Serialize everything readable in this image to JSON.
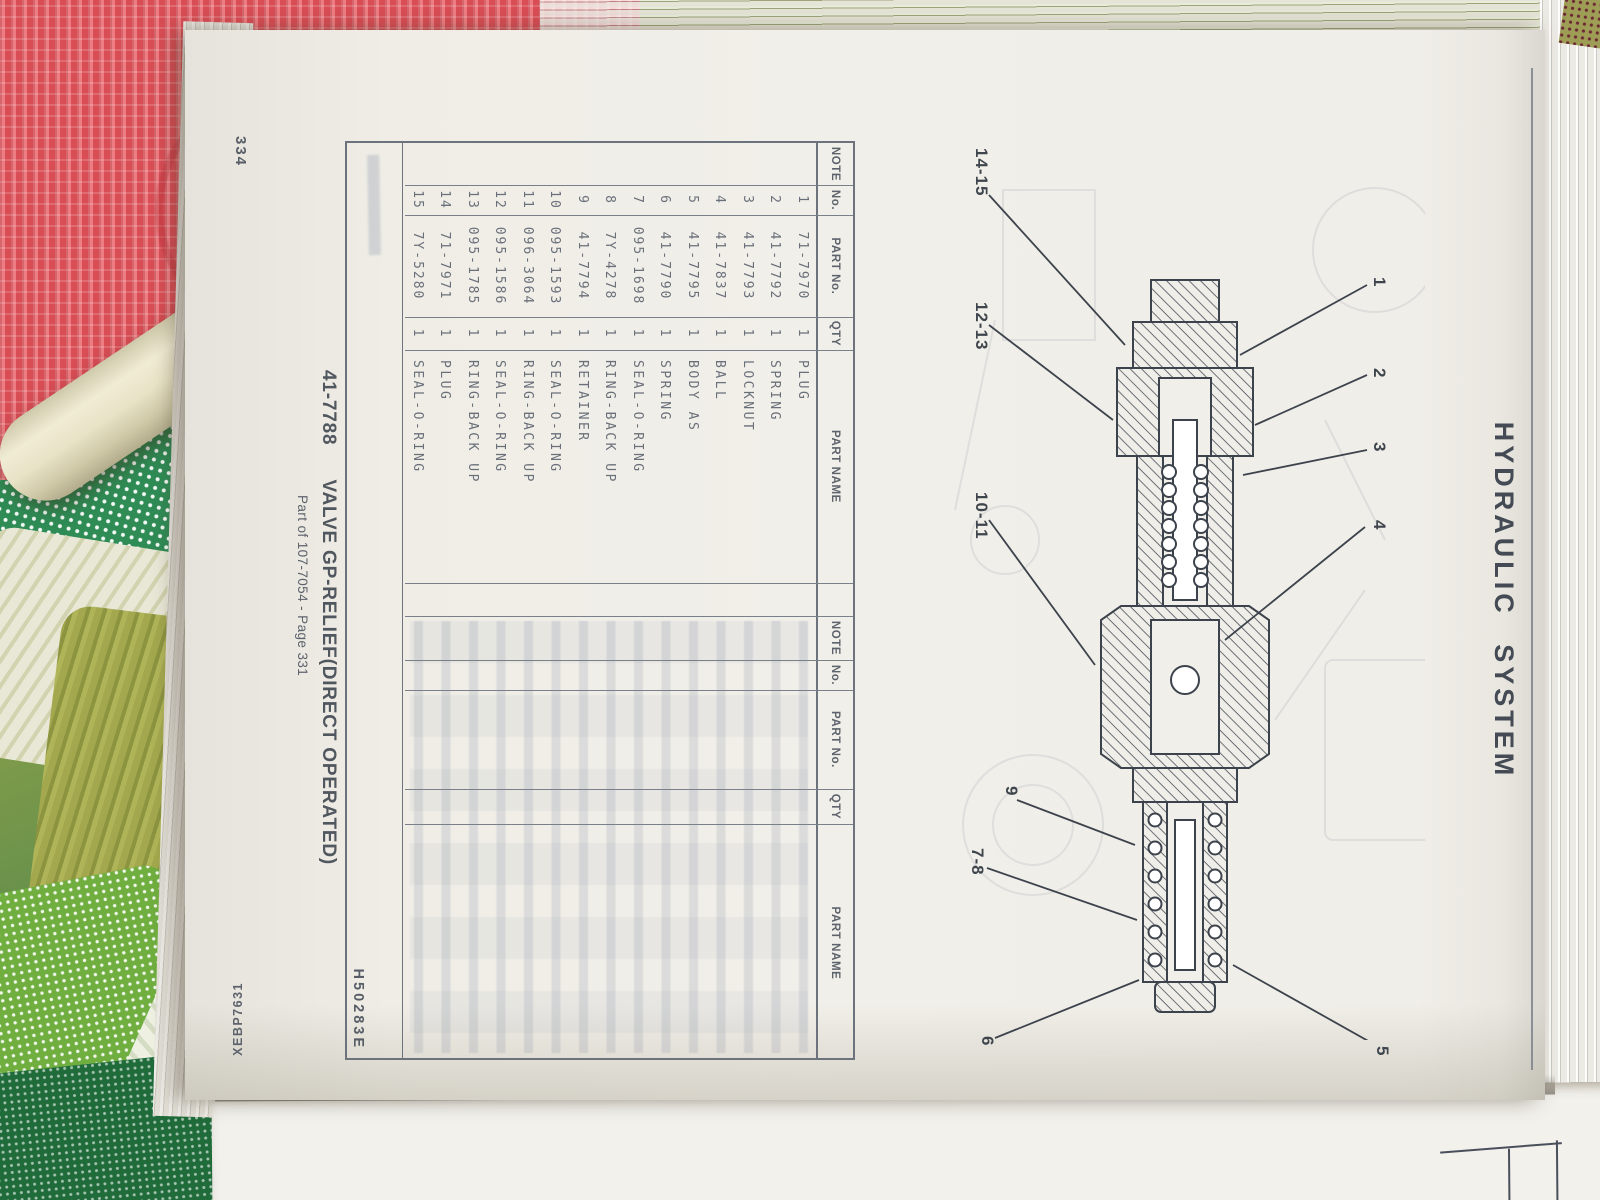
{
  "page": {
    "section_title": "HYDRAULIC SYSTEM",
    "page_number": "334",
    "form_code": "XEBP7631",
    "figure_code": "H50283E",
    "caption_part_no": "41-7788",
    "caption_title": "VALVE GP-RELIEF(DIRECT OPERATED)",
    "caption_subtitle": "Part of 107-7054 - Page 331"
  },
  "figure": {
    "callouts": [
      "1",
      "2",
      "3",
      "4",
      "5",
      "6",
      "7-8",
      "9",
      "10-11",
      "12-13",
      "14-15"
    ]
  },
  "table": {
    "headers": [
      "NOTE",
      "No.",
      "PART No.",
      "QTY",
      "PART NAME"
    ],
    "rows": [
      {
        "note": "",
        "no": "1",
        "part_no": "71-7970",
        "qty": "1",
        "part_name": "PLUG"
      },
      {
        "note": "",
        "no": "2",
        "part_no": "41-7792",
        "qty": "1",
        "part_name": "SPRING"
      },
      {
        "note": "",
        "no": "3",
        "part_no": "41-7793",
        "qty": "1",
        "part_name": "LOCKNUT"
      },
      {
        "note": "",
        "no": "4",
        "part_no": "41-7837",
        "qty": "1",
        "part_name": "BALL"
      },
      {
        "note": "",
        "no": "5",
        "part_no": "41-7795",
        "qty": "1",
        "part_name": "BODY AS"
      },
      {
        "note": "",
        "no": "6",
        "part_no": "41-7790",
        "qty": "1",
        "part_name": "SPRING"
      },
      {
        "note": "",
        "no": "7",
        "part_no": "095-1698",
        "qty": "1",
        "part_name": "SEAL-O-RING"
      },
      {
        "note": "",
        "no": "8",
        "part_no": "7Y-4278",
        "qty": "1",
        "part_name": "RING-BACK UP"
      },
      {
        "note": "",
        "no": "9",
        "part_no": "41-7794",
        "qty": "1",
        "part_name": "RETAINER"
      },
      {
        "note": "",
        "no": "10",
        "part_no": "095-1593",
        "qty": "1",
        "part_name": "SEAL-O-RING"
      },
      {
        "note": "",
        "no": "11",
        "part_no": "096-3064",
        "qty": "1",
        "part_name": "RING-BACK UP"
      },
      {
        "note": "",
        "no": "12",
        "part_no": "095-1586",
        "qty": "1",
        "part_name": "SEAL-O-RING"
      },
      {
        "note": "",
        "no": "13",
        "part_no": "095-1785",
        "qty": "1",
        "part_name": "RING-BACK UP"
      },
      {
        "note": "",
        "no": "14",
        "part_no": "71-7971",
        "qty": "1",
        "part_name": "PLUG"
      },
      {
        "note": "",
        "no": "15",
        "part_no": "7Y-5280",
        "qty": "1",
        "part_name": "SEAL-O-RING"
      }
    ]
  }
}
